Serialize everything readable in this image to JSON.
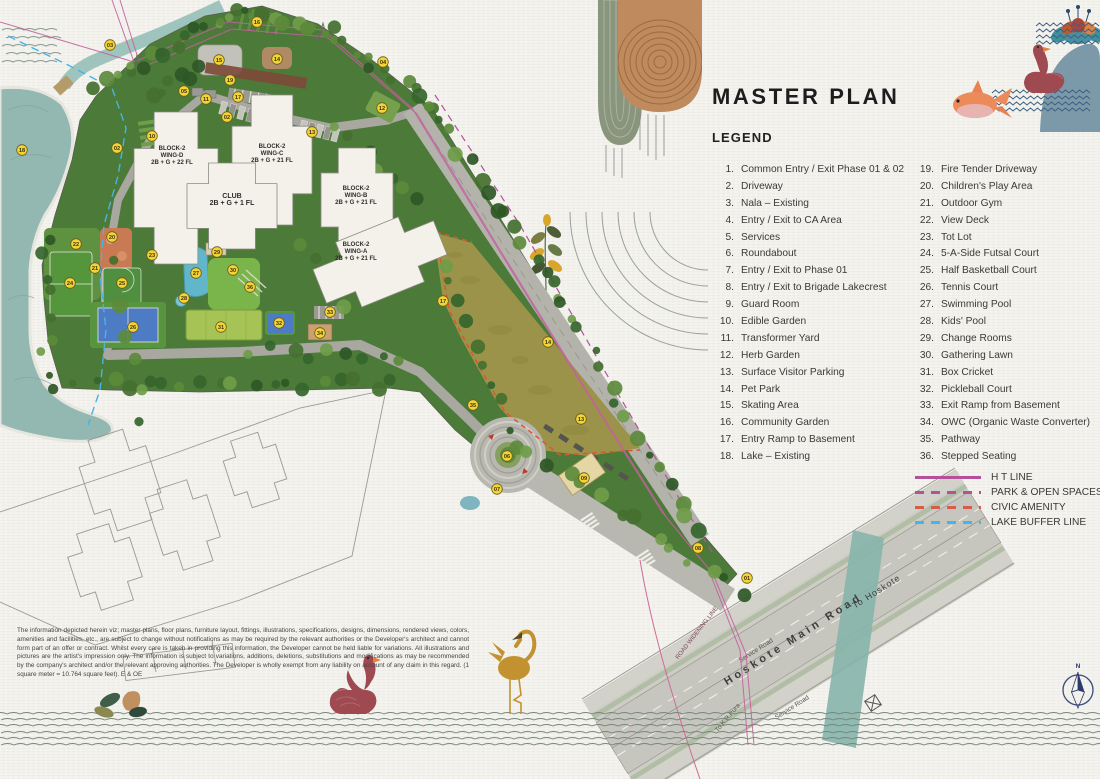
{
  "title": "MASTER PLAN",
  "legend": {
    "heading": "LEGEND",
    "items_col1": [
      {
        "num": "1.",
        "label": "Common Entry / Exit Phase 01 & 02"
      },
      {
        "num": "2.",
        "label": "Driveway"
      },
      {
        "num": "3.",
        "label": "Nala – Existing"
      },
      {
        "num": "4.",
        "label": "Entry / Exit to CA Area"
      },
      {
        "num": "5.",
        "label": "Services"
      },
      {
        "num": "6.",
        "label": "Roundabout"
      },
      {
        "num": "7.",
        "label": "Entry / Exit to Phase 01"
      },
      {
        "num": "8.",
        "label": "Entry / Exit to Brigade Lakecrest"
      },
      {
        "num": "9.",
        "label": "Guard Room"
      },
      {
        "num": "10.",
        "label": "Edible Garden"
      },
      {
        "num": "11.",
        "label": "Transformer Yard"
      },
      {
        "num": "12.",
        "label": "Herb Garden"
      },
      {
        "num": "13.",
        "label": "Surface Visitor Parking"
      },
      {
        "num": "14.",
        "label": "Pet Park"
      },
      {
        "num": "15.",
        "label": "Skating Area"
      },
      {
        "num": "16.",
        "label": "Community Garden"
      },
      {
        "num": "17.",
        "label": "Entry Ramp to Basement"
      },
      {
        "num": "18.",
        "label": "Lake – Existing"
      }
    ],
    "items_col2": [
      {
        "num": "19.",
        "label": "Fire Tender Driveway"
      },
      {
        "num": "20.",
        "label": "Children's Play Area"
      },
      {
        "num": "21.",
        "label": "Outdoor Gym"
      },
      {
        "num": "22.",
        "label": "View Deck"
      },
      {
        "num": "23.",
        "label": "Tot Lot"
      },
      {
        "num": "24.",
        "label": "5-A-Side Futsal Court"
      },
      {
        "num": "25.",
        "label": "Half Basketball Court"
      },
      {
        "num": "26.",
        "label": "Tennis Court"
      },
      {
        "num": "27.",
        "label": "Swimming Pool"
      },
      {
        "num": "28.",
        "label": "Kids' Pool"
      },
      {
        "num": "29.",
        "label": "Change Rooms"
      },
      {
        "num": "30.",
        "label": "Gathering Lawn"
      },
      {
        "num": "31.",
        "label": "Box Cricket"
      },
      {
        "num": "32.",
        "label": "Pickleball Court"
      },
      {
        "num": "33.",
        "label": "Exit Ramp from Basement"
      },
      {
        "num": "34.",
        "label": "OWC (Organic Waste Converter)"
      },
      {
        "num": "35.",
        "label": "Pathway"
      },
      {
        "num": "36.",
        "label": "Stepped Seating"
      }
    ],
    "lines": [
      {
        "label": "H T LINE",
        "color": "#b5519c",
        "style": "solid"
      },
      {
        "label": "PARK & OPEN SPACES",
        "color": "#b5519c",
        "style": "dashed"
      },
      {
        "label": "CIVIC AMENITY",
        "color": "#d85c4a",
        "style": "dashed"
      },
      {
        "label": "LAKE BUFFER LINE",
        "color": "#45b4e8",
        "style": "dashed"
      }
    ]
  },
  "plan": {
    "blocks": [
      {
        "name": "BLOCK-2",
        "wing": "WING-D",
        "floors": "2B + G + 22 FL",
        "x": 172,
        "y": 150
      },
      {
        "name": "BLOCK-2",
        "wing": "WING-C",
        "floors": "2B + G + 21 FL",
        "x": 272,
        "y": 148
      },
      {
        "name": "CLUB",
        "wing": "",
        "floors": "2B + G + 1 FL",
        "x": 232,
        "y": 198
      },
      {
        "name": "BLOCK-2",
        "wing": "WING-B",
        "floors": "2B + G + 21 FL",
        "x": 356,
        "y": 190
      },
      {
        "name": "BLOCK-2",
        "wing": "WING-A",
        "floors": "2B + G + 21 FL",
        "x": 356,
        "y": 246
      }
    ],
    "roads": {
      "main": "Hoskote Main Road",
      "to_hoskote": "To Hoskote",
      "service": "Service Road",
      "to_krpura": "To K.R.Pura",
      "widening": "ROAD WIDENING LINE"
    },
    "compass_n": "N",
    "markers": [
      {
        "n": "01",
        "x": 747,
        "y": 578
      },
      {
        "n": "02",
        "x": 227,
        "y": 117
      },
      {
        "n": "02",
        "x": 117,
        "y": 148
      },
      {
        "n": "03",
        "x": 110,
        "y": 45
      },
      {
        "n": "04",
        "x": 383,
        "y": 62
      },
      {
        "n": "05",
        "x": 184,
        "y": 91
      },
      {
        "n": "06",
        "x": 507,
        "y": 456
      },
      {
        "n": "07",
        "x": 497,
        "y": 489
      },
      {
        "n": "08",
        "x": 698,
        "y": 548
      },
      {
        "n": "09",
        "x": 584,
        "y": 478
      },
      {
        "n": "10",
        "x": 152,
        "y": 136
      },
      {
        "n": "11",
        "x": 206,
        "y": 99
      },
      {
        "n": "12",
        "x": 382,
        "y": 108
      },
      {
        "n": "13",
        "x": 312,
        "y": 132
      },
      {
        "n": "13",
        "x": 581,
        "y": 419
      },
      {
        "n": "14",
        "x": 277,
        "y": 59
      },
      {
        "n": "14",
        "x": 548,
        "y": 342
      },
      {
        "n": "15",
        "x": 219,
        "y": 60
      },
      {
        "n": "16",
        "x": 257,
        "y": 22
      },
      {
        "n": "17",
        "x": 238,
        "y": 97
      },
      {
        "n": "17",
        "x": 443,
        "y": 301
      },
      {
        "n": "18",
        "x": 22,
        "y": 150
      },
      {
        "n": "19",
        "x": 230,
        "y": 80
      },
      {
        "n": "20",
        "x": 112,
        "y": 237
      },
      {
        "n": "21",
        "x": 95,
        "y": 268
      },
      {
        "n": "22",
        "x": 76,
        "y": 244
      },
      {
        "n": "23",
        "x": 152,
        "y": 255
      },
      {
        "n": "24",
        "x": 70,
        "y": 283
      },
      {
        "n": "25",
        "x": 122,
        "y": 283
      },
      {
        "n": "26",
        "x": 133,
        "y": 327
      },
      {
        "n": "27",
        "x": 196,
        "y": 273
      },
      {
        "n": "28",
        "x": 184,
        "y": 298
      },
      {
        "n": "29",
        "x": 217,
        "y": 252
      },
      {
        "n": "30",
        "x": 233,
        "y": 270
      },
      {
        "n": "31",
        "x": 221,
        "y": 327
      },
      {
        "n": "32",
        "x": 279,
        "y": 323
      },
      {
        "n": "33",
        "x": 330,
        "y": 312
      },
      {
        "n": "34",
        "x": 320,
        "y": 333
      },
      {
        "n": "35",
        "x": 473,
        "y": 405
      },
      {
        "n": "36",
        "x": 250,
        "y": 287
      }
    ]
  },
  "disclaimer": "The information depicted herein viz; master plans, floor plans, furniture layout, fittings, illustrations, specifications, designs, dimensions, rendered views, colors, amenities and facilities, etc., are subject to change without notifications as may be required by the relevant authorities or the Developer's architect and cannot form part of an offer or contract. Whilst every care is taken in providing this information, the Developer cannot be held liable for variations. All illustrations and pictures are the artist's impression only. The information is subject to variations, additions, deletions, substitutions and modifications as may be recommended by the company's architect and/or the relevant approving authorities. The Developer is wholly exempt from any liability on account of any claim in this regard. (1 square meter = 10.764 square feet). E & OE",
  "colors": {
    "paper": "#f2f1ec",
    "site_green": "#4c7a38",
    "lake": "#93b7b1",
    "ca_olive": "#9b9349",
    "road": "#c6c6be",
    "marker": "#f2d437",
    "ht_line": "#b5519c",
    "civic": "#d85c4a",
    "lake_buffer": "#45b4e8",
    "title_text": "#1d1d1d"
  }
}
